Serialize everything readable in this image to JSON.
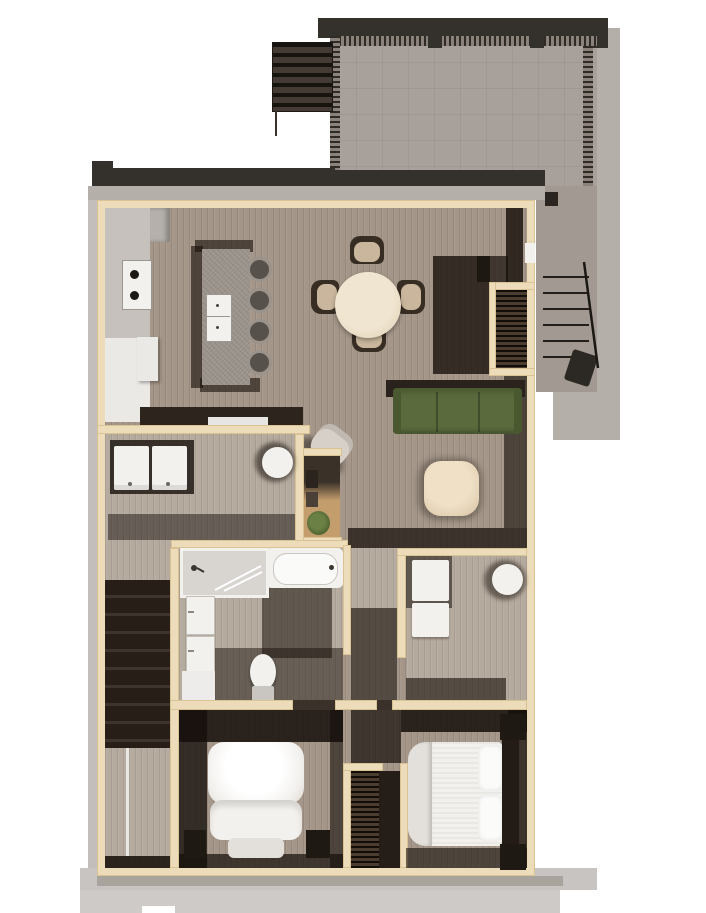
{
  "scene": {
    "type": "architectural-floor-plan-render",
    "description": "Top-down 3D rendered floor plan of an apartment unit with roof deck, exterior stair, kitchen island, dining table, living area, laundry, bathroom, utility room, interior stairs and two bedrooms",
    "width_px": 706,
    "height_px": 913,
    "visible_text": ""
  },
  "rooms": [
    "roof-deck",
    "exterior-stair",
    "kitchen",
    "dining-area",
    "living-room",
    "laundry-room",
    "bathroom",
    "utility-room",
    "hall-pocket",
    "stairwell",
    "entry",
    "interior-stair",
    "bedroom-1",
    "bedroom-2",
    "closet"
  ],
  "furniture": [
    "louver-canopy",
    "kitchen-island",
    "island-sink",
    "bar-stool",
    "cooktop",
    "fridge",
    "counter",
    "dining-table",
    "dining-chair",
    "sofa",
    "coffee-table",
    "armchair",
    "decor-niche",
    "plant",
    "washer",
    "dryer",
    "water-heater",
    "shower",
    "bathtub",
    "vanity-sink",
    "linen-cabinet",
    "toilet",
    "stacked-laundry-units",
    "bed",
    "pillow",
    "nightstand",
    "hanging-clothes",
    "entry-door",
    "wall-fixture",
    "railing"
  ],
  "colors": {
    "background": "#ffffff",
    "wall_cream": "#ecdcb9",
    "wall_edge": "#d9c294",
    "floor_wood": "#a49688",
    "floor_light": "#b5aa9e",
    "floor_dark": "#2a211a",
    "deck_slab": "#a8a09a",
    "roof_dark": "#34302b",
    "fascia_gray": "#b5afaa",
    "fascia_light": "#c3bebb",
    "apron_gray": "#c8c4c1",
    "apron_mid": "#a9a39e",
    "apron_light": "#cecac7",
    "rail_tick": "#2e2a25",
    "rail_base": "#8a827b",
    "stair_ext": "#a19992",
    "stair_dark": "#261e17",
    "island_gray": "#99928a",
    "counter_gray": "#c6c1bc",
    "counter_white": "#ebe9e6",
    "fixture_white": "#f2f1ee",
    "sofa_green": "#5a6a3d",
    "sofa_green_dark": "#49582f",
    "table_tan": "#e8dac2",
    "chair_tan": "#c9b69c",
    "chair_dark": "#382d23",
    "coffee_tan": "#e2cfb2",
    "armchair_gray": "#d6d0c9",
    "niche_tan": "#c49d6d",
    "plant_green": "#4e6132",
    "furniture_dark": "#1f1913",
    "bed_white": "#f3f1ee",
    "bed_shade": "#e3e0db",
    "toilet_base": "#c9c5c1",
    "closet_brown": "#4b3e31"
  }
}
